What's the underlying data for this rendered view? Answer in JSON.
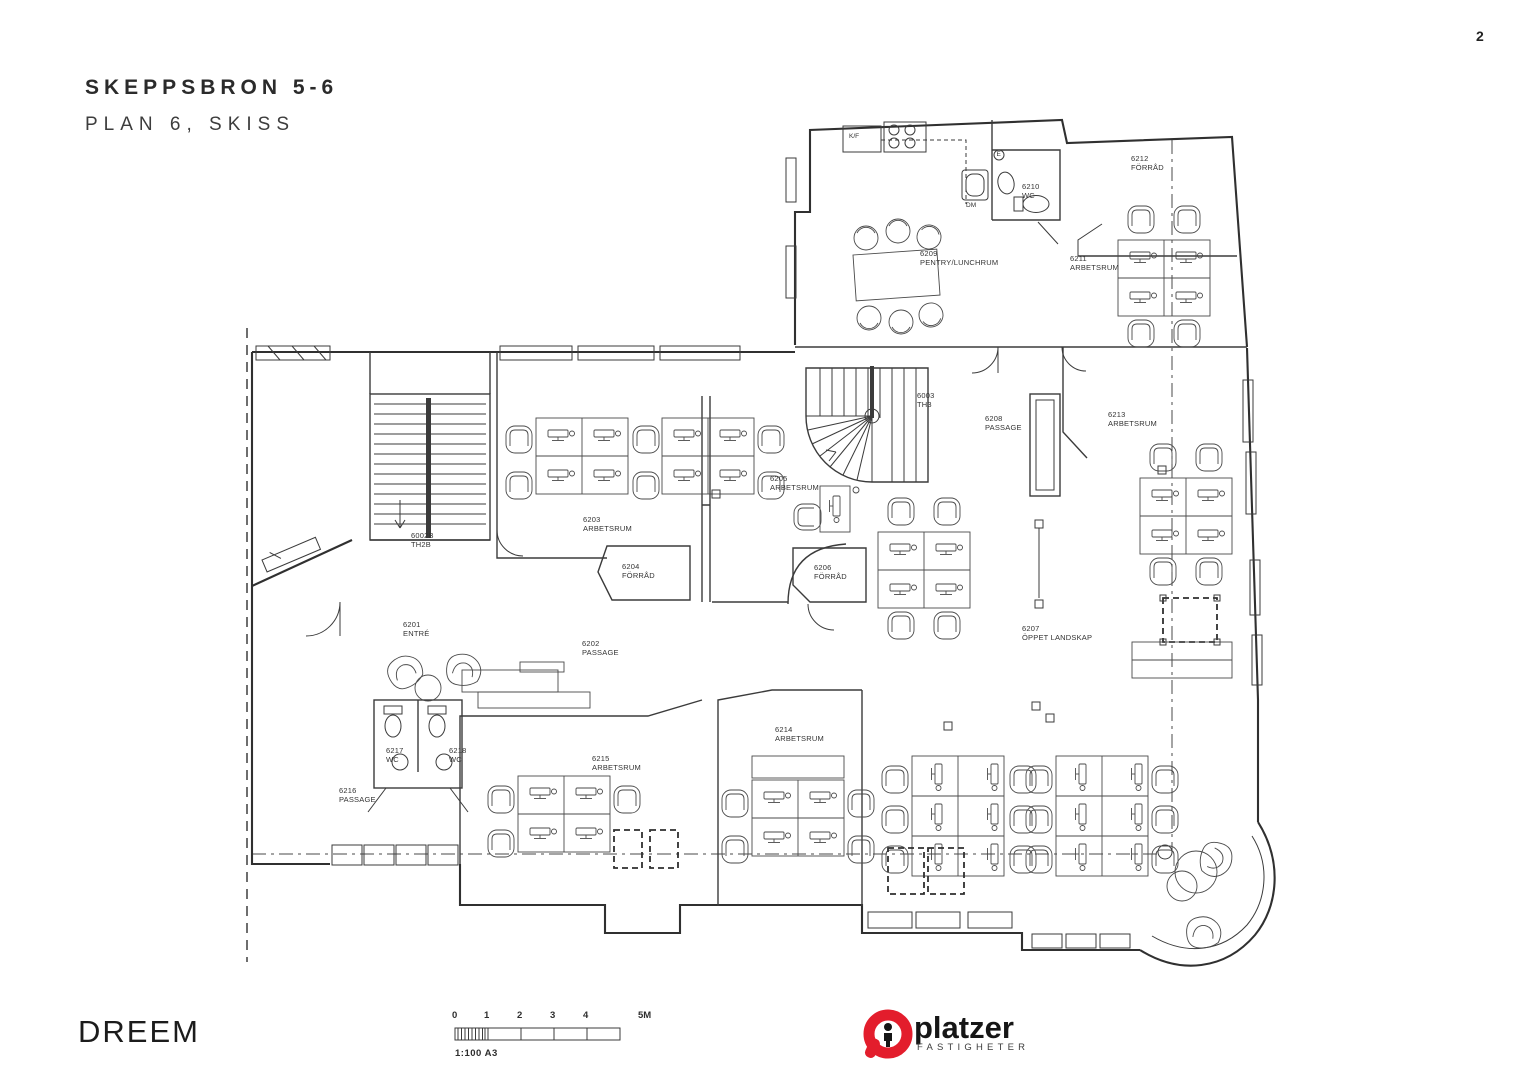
{
  "page": {
    "number": "2"
  },
  "header": {
    "title": "SKEPPSBRON 5-6",
    "subtitle": "PLAN 6, SKISS"
  },
  "plan": {
    "rooms": [
      {
        "code": "6209",
        "name": "PENTRY/LUNCHRUM"
      },
      {
        "code": "6210",
        "name": "WC"
      },
      {
        "code": "6212",
        "name": "FÖRRÅD"
      },
      {
        "code": "6211",
        "name": "ARBETSRUM"
      },
      {
        "code": "6003",
        "name": "TH3"
      },
      {
        "code": "6208",
        "name": "PASSAGE"
      },
      {
        "code": "6213",
        "name": "ARBETSRUM"
      },
      {
        "code": "6205",
        "name": "ARBETSRUM"
      },
      {
        "code": "6203",
        "name": "ARBETSRUM"
      },
      {
        "code": "6204",
        "name": "FÖRRÅD"
      },
      {
        "code": "6206",
        "name": "FÖRRÅD"
      },
      {
        "code": "6002B",
        "name": "TH2B"
      },
      {
        "code": "6201",
        "name": "ENTRÉ"
      },
      {
        "code": "6202",
        "name": "PASSAGE"
      },
      {
        "code": "6207",
        "name": "ÖPPET LANDSKAP"
      },
      {
        "code": "6214",
        "name": "ARBETSRUM"
      },
      {
        "code": "6215",
        "name": "ARBETSRUM"
      },
      {
        "code": "6217",
        "name": "WC"
      },
      {
        "code": "6218",
        "name": "WC"
      },
      {
        "code": "6216",
        "name": "PASSAGE"
      }
    ],
    "fixtures": {
      "fridge": "K/F",
      "dishwasher": "DM",
      "vent": "E"
    }
  },
  "footer": {
    "brand": "DREEM",
    "scale": {
      "ticks": [
        "0",
        "1",
        "2",
        "3",
        "4",
        "5M"
      ],
      "note": "1:100 A3"
    },
    "logo": {
      "name": "platzer",
      "sub": "FASTIGHETER",
      "red": "#e31d2c"
    }
  }
}
